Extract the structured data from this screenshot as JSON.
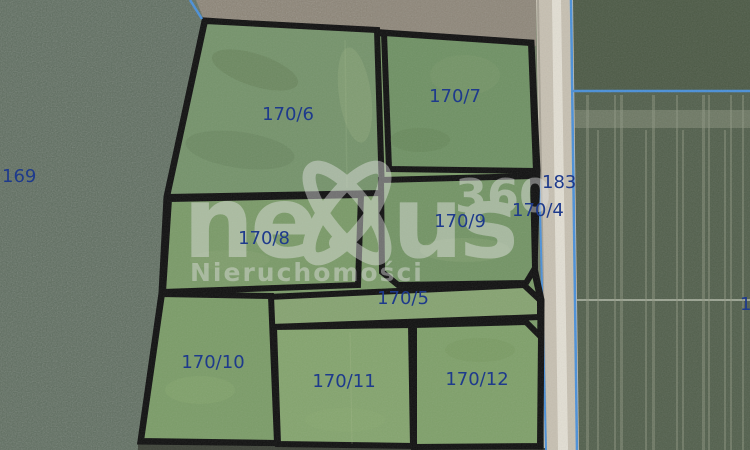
{
  "map": {
    "description": "Satellite cadastral map of subdivided land parcels outlined in black",
    "parcels": {
      "p6": {
        "label": "170/6"
      },
      "p7": {
        "label": "170/7"
      },
      "p8": {
        "label": "170/8"
      },
      "p9": {
        "label": "170/9"
      },
      "p5": {
        "label": "170/5"
      },
      "p10": {
        "label": "170/10"
      },
      "p11": {
        "label": "170/11"
      },
      "p12": {
        "label": "170/12"
      }
    },
    "neighbor_labels": {
      "west_field": "169",
      "road_strip": "183",
      "road_parcel": "170/4",
      "east_edge_partial": "1"
    },
    "colors": {
      "parcel_fill": "#7a9a68",
      "parcel_boundary": "#101010",
      "parcel_label": "#1e3a8c",
      "cadastral_line_blue": "#4a90d9",
      "road": "#c7c0b1",
      "west_field": "#5d6c5e",
      "north_field": "#8b8375",
      "east_field": "#4e5c48",
      "watermark_gray": "#e4e4e4"
    }
  },
  "watermark": {
    "brand_left": "ne",
    "brand_right": "us",
    "superscript": "360",
    "subtitle": "Nieruchomości"
  }
}
